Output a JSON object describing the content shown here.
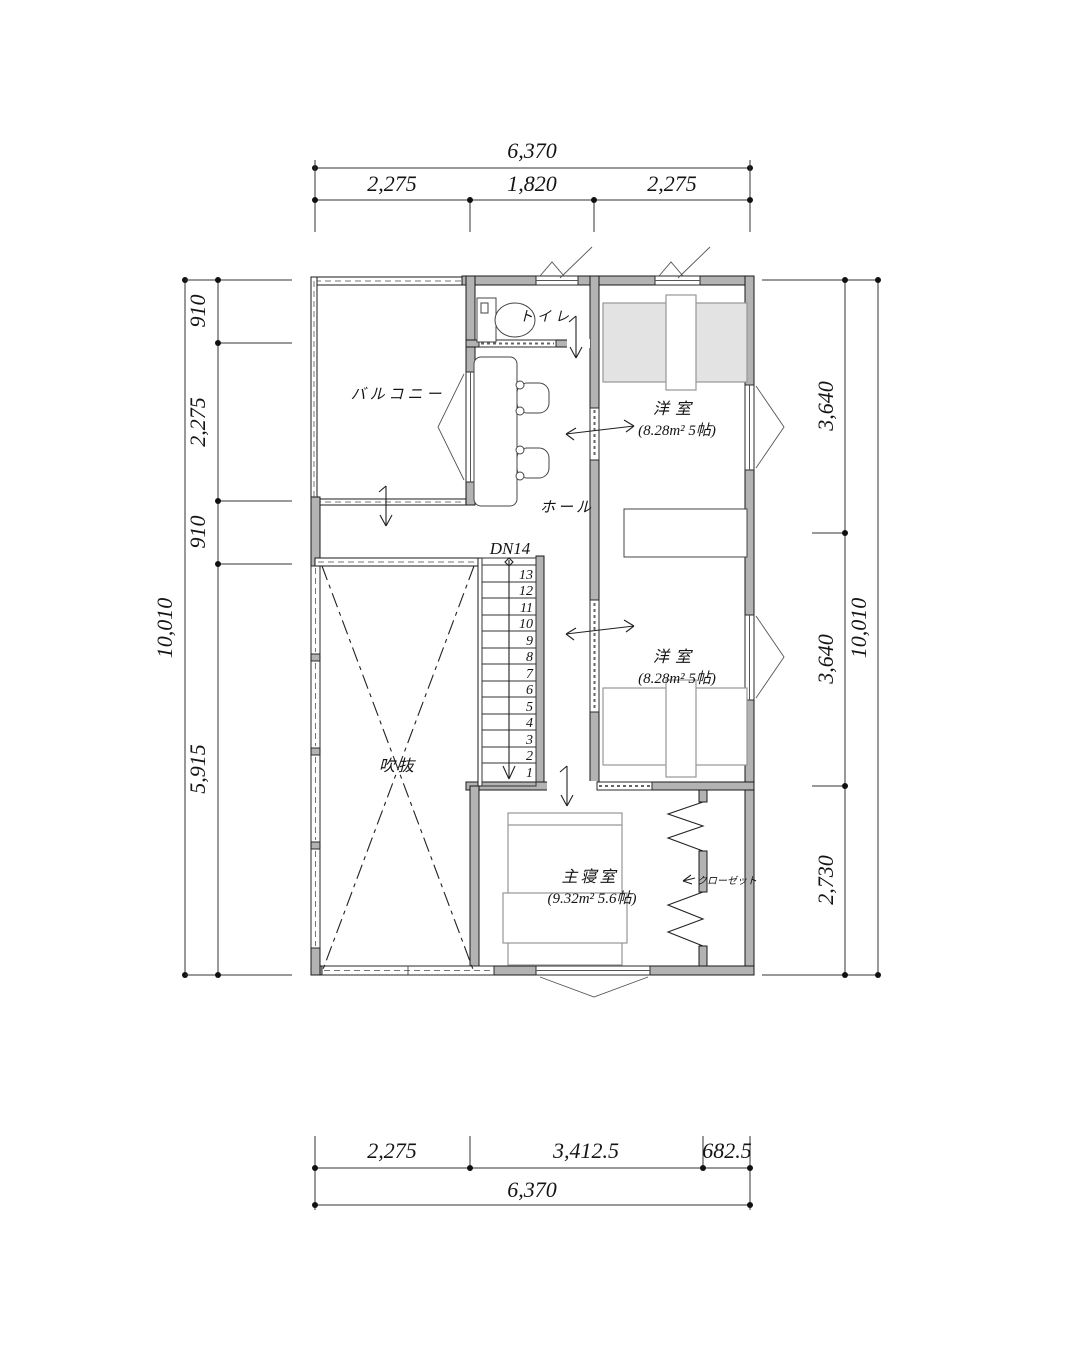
{
  "dims": {
    "top": {
      "overall": "6,370",
      "seg": [
        "2,275",
        "1,820",
        "2,275"
      ]
    },
    "bottom": {
      "overall": "6,370",
      "seg": [
        "2,275",
        "3,412.5",
        "682.5"
      ]
    },
    "left": {
      "overall": "10,010",
      "seg": [
        "910",
        "2,275",
        "910",
        "5,915"
      ]
    },
    "right": {
      "overall": "10,010",
      "seg": [
        "3,640",
        "3,640",
        "2,730"
      ]
    }
  },
  "rooms": {
    "balcony": {
      "label": "バルコニー"
    },
    "toilet": {
      "label": "トイレ"
    },
    "hall": {
      "label": "ホール"
    },
    "western1": {
      "label": "洋室",
      "area": "(8.28m² 5帖)"
    },
    "western2": {
      "label": "洋室",
      "area": "(8.28m² 5帖)"
    },
    "master": {
      "label": "主寝室",
      "area": "(9.32m² 5.6帖)"
    },
    "closet": {
      "label": "クローゼット"
    },
    "void": {
      "label": "吹抜"
    }
  },
  "stairs": {
    "label": "DN14",
    "numbers": [
      "13",
      "12",
      "11",
      "10",
      "9",
      "8",
      "7",
      "6",
      "5",
      "4",
      "3",
      "2",
      "1"
    ]
  },
  "colors": {
    "wall": "#b3b3b3",
    "line": "#1a1a1a",
    "furniture": "#8a8a8a",
    "bed_fill": "#e3e3e3"
  }
}
